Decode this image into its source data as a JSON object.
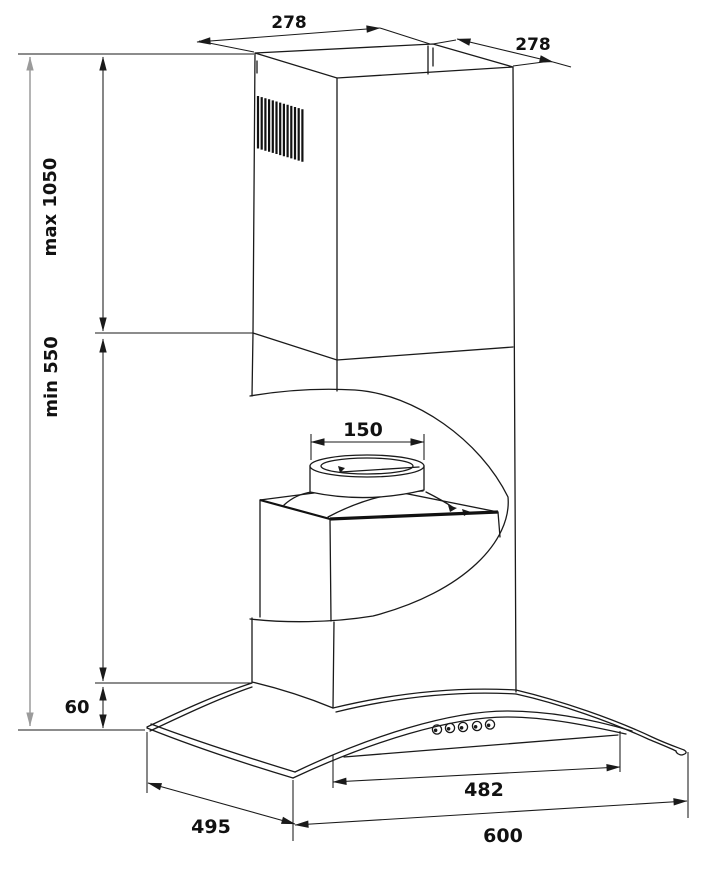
{
  "diagram": {
    "type": "cooker-hood installation drawing",
    "units_implied": "mm",
    "dimensions": {
      "chimney_top_width": "278",
      "chimney_top_depth": "278",
      "height_max": "max 1050",
      "height_min": "min 550",
      "canopy_back_height": "60",
      "duct_collar_diameter": "150",
      "control_panel_width": "482",
      "canopy_depth": "495",
      "canopy_width": "600"
    },
    "colors": {
      "line": "#1a1a1a",
      "overall_dimension_line": "#9b9b9b",
      "background": "#ffffff"
    },
    "features": {
      "vent_grille_slats": 13,
      "control_buttons": 5
    }
  }
}
